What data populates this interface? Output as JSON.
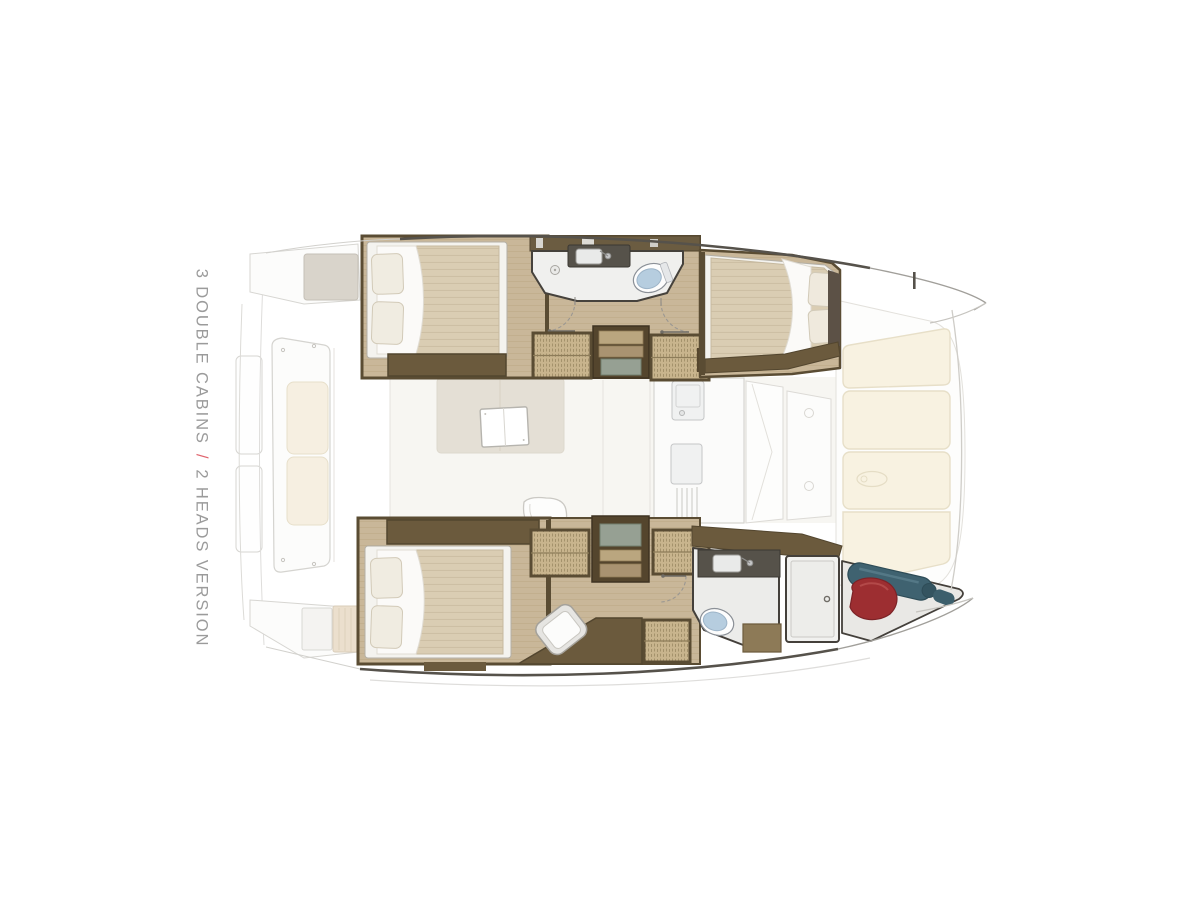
{
  "label": {
    "line": "3 DOUBLE CABINS / 2 HEADS VERSION",
    "part1": "3 DOUBLE CABINS",
    "separator": "/",
    "part2": "2 HEADS VERSION"
  },
  "colors": {
    "background": "#ffffff",
    "label_text": "#9b9b9b",
    "label_separator": "#e0646e",
    "wood_floor": "#c9b799",
    "dark_joinery": "#6b5a3d",
    "cabin_frame": "#5a4c33",
    "mattress": "#dacdb3",
    "pillow": "#f0ece1",
    "wicker": "#c8b48d",
    "stair_tread_green": "#96a093",
    "toilet_blue": "#b6cddf",
    "cream_cushion": "#f8f2e1",
    "ghost_outline": "#d5d4d0",
    "red_bag": "#9d2e31",
    "teal_fender": "#3f6270"
  }
}
